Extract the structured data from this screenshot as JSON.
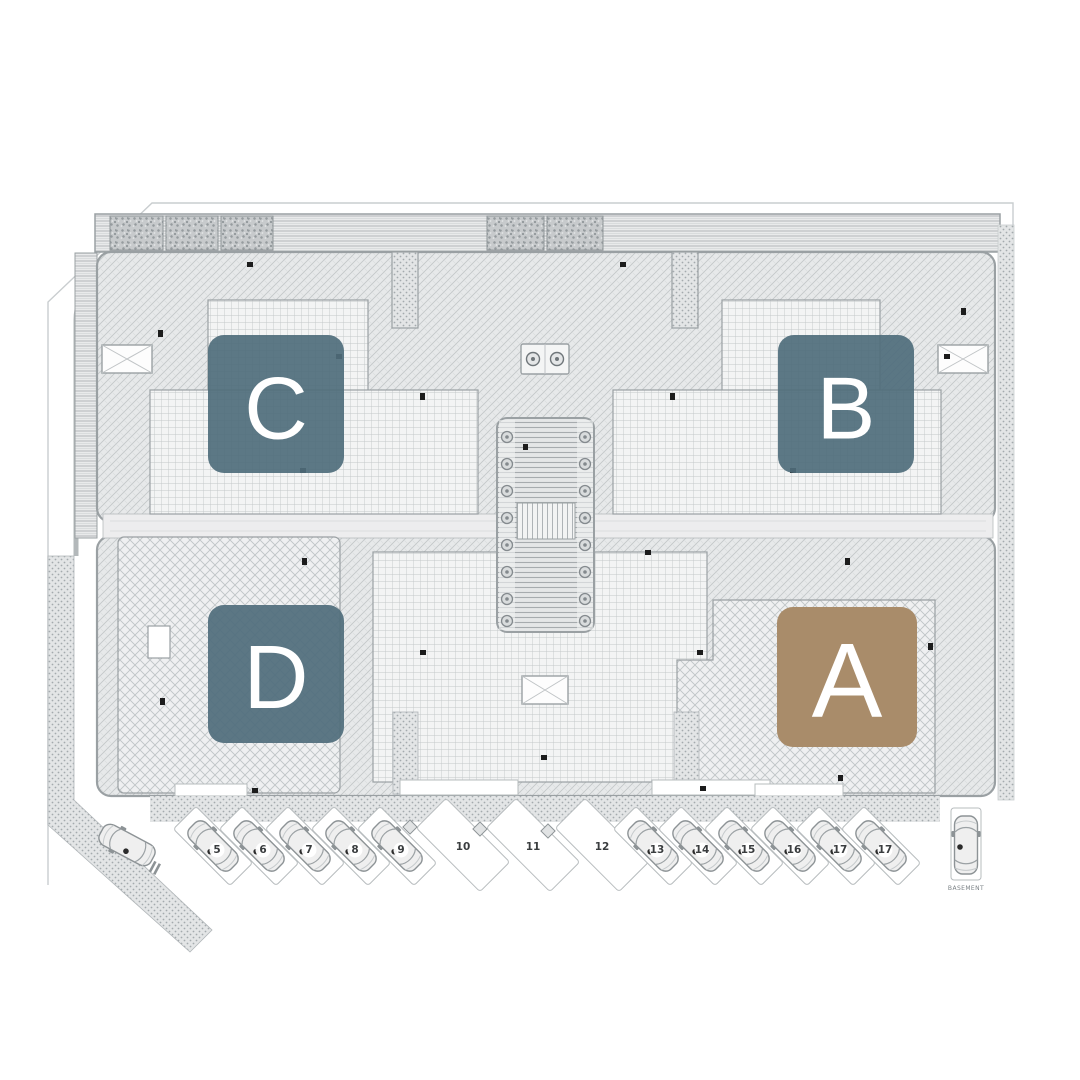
{
  "blocks": [
    {
      "id": "C",
      "label": "C",
      "color": "#4f6c7b",
      "highlighted": false
    },
    {
      "id": "B",
      "label": "B",
      "color": "#4f6c7b",
      "highlighted": false
    },
    {
      "id": "D",
      "label": "D",
      "color": "#4f6c7b",
      "highlighted": false
    },
    {
      "id": "A",
      "label": "A",
      "color": "#a98c6a",
      "highlighted": true
    }
  ],
  "parking": {
    "spaces": [
      {
        "number": "5",
        "occupied": true
      },
      {
        "number": "6",
        "occupied": true
      },
      {
        "number": "7",
        "occupied": true
      },
      {
        "number": "8",
        "occupied": true
      },
      {
        "number": "9",
        "occupied": true
      },
      {
        "number": "10",
        "occupied": false
      },
      {
        "number": "11",
        "occupied": false
      },
      {
        "number": "12",
        "occupied": false
      },
      {
        "number": "13",
        "occupied": true
      },
      {
        "number": "14",
        "occupied": true
      },
      {
        "number": "15",
        "occupied": true
      },
      {
        "number": "16",
        "occupied": true
      },
      {
        "number": "17",
        "occupied": true
      },
      {
        "number": "17",
        "occupied": true
      }
    ],
    "basement_label": "BASEMENT"
  },
  "colors": {
    "block_blue": "#4f6c7b",
    "block_highlight_brown": "#a98c6a",
    "letter_white": "#ffffff",
    "line_gray": "#9aa0a3",
    "background": "#ffffff"
  }
}
